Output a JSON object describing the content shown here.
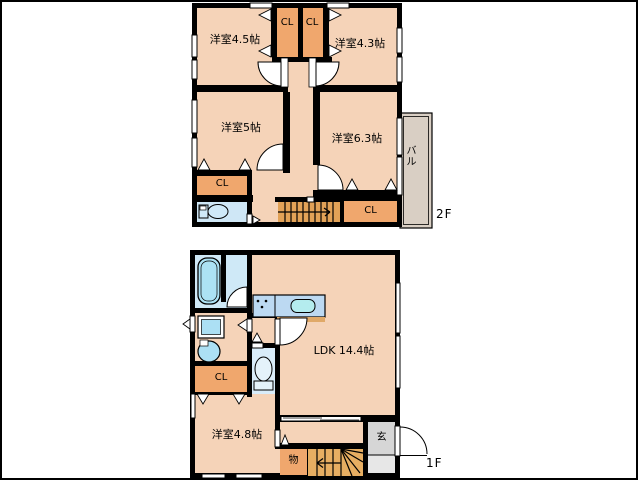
{
  "floor2": {
    "label": "2F",
    "rooms": [
      {
        "id": "room-4-5",
        "label": "洋室4.5帖"
      },
      {
        "id": "closet-top-left",
        "label": "CL"
      },
      {
        "id": "closet-top-right",
        "label": "CL"
      },
      {
        "id": "room-4-3",
        "label": "洋室4.3帖"
      },
      {
        "id": "room-5",
        "label": "洋室5帖"
      },
      {
        "id": "room-6-3",
        "label": "洋室6.3帖"
      },
      {
        "id": "balcony",
        "label": "バル"
      },
      {
        "id": "closet-bottom-left",
        "label": "CL"
      },
      {
        "id": "closet-bottom-right",
        "label": "CL"
      }
    ]
  },
  "floor1": {
    "label": "1F",
    "rooms": [
      {
        "id": "ldk",
        "label": "LDK 14.4帖"
      },
      {
        "id": "closet",
        "label": "CL"
      },
      {
        "id": "room-4-8",
        "label": "洋室4.8帖"
      },
      {
        "id": "storage",
        "label": "物"
      },
      {
        "id": "entrance",
        "label": "玄"
      }
    ]
  },
  "colors": {
    "room_floor": "#f5d3b8",
    "closet": "#f0a76d",
    "stairs": "#e2a257",
    "stairs_1f": "#e7ae62",
    "balcony": "#d9cfc4",
    "bathroom": "#cfe9f7",
    "fixture_blue": "#ace0f4",
    "kitchen_counter": "#bcd9f2",
    "kitchen_sink": "#b4ecee",
    "entrance_gray": "#d6d6d6",
    "wall": "#000000"
  },
  "icons": [
    "bathtub-icon",
    "washing-machine-icon",
    "basin-icon",
    "toilet-icon",
    "kitchen-sink-icon",
    "stove-icon",
    "stairs-icon",
    "door-swing-icon"
  ]
}
